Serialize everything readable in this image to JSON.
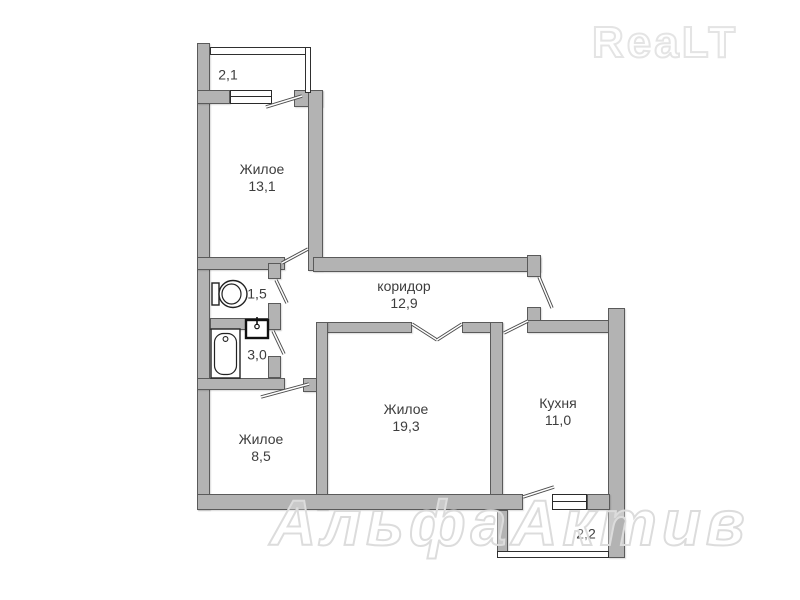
{
  "watermarks": {
    "brand": "ReaLT",
    "agency": "АльфаАктив"
  },
  "colors": {
    "wall_fill": "#b3b3b3",
    "wall_edge": "#5a5a5a",
    "label_text": "#3d3d3d",
    "watermark": "#e4e4e4"
  },
  "rooms": {
    "balcony_top": {
      "area": "2,1"
    },
    "room13": {
      "name": "Жилое",
      "area": "13,1"
    },
    "corridor": {
      "name": "коридор",
      "area": "12,9"
    },
    "wc": {
      "area": "1,5"
    },
    "bath": {
      "area": "3,0"
    },
    "room8": {
      "name": "Жилое",
      "area": "8,5"
    },
    "room19": {
      "name": "Жилое",
      "area": "19,3"
    },
    "kitchen": {
      "name": "Кухня",
      "area": "11,0"
    },
    "balcony_bottom": {
      "area": "2,2"
    }
  }
}
